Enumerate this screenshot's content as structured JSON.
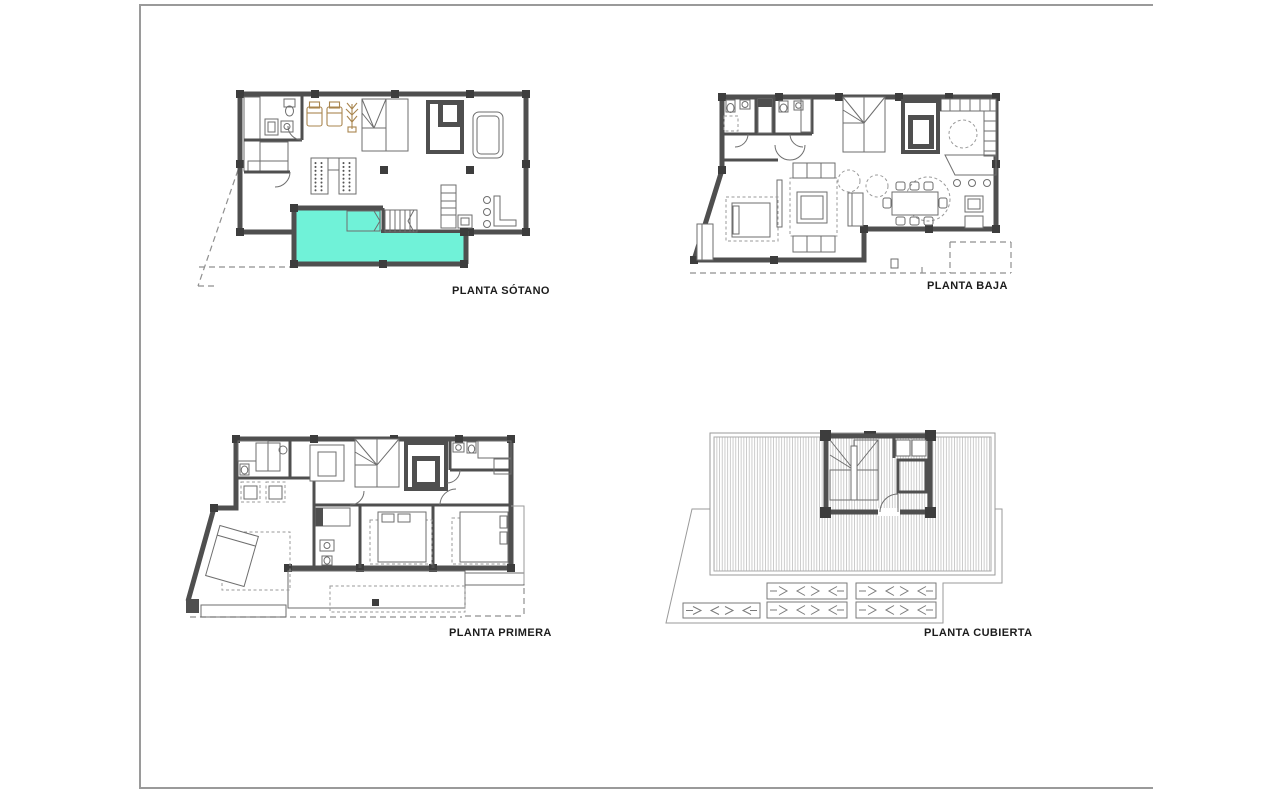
{
  "sheet": {
    "type": "architectural floor plan sheet",
    "frame_color": "#9a9a9a",
    "background": "#ffffff"
  },
  "drawing": {
    "wall_color": "#4f4f4f",
    "wall_dark": "#3d3d3d",
    "line_color": "#6e6e6e",
    "hatch_color": "#b3b3b3",
    "dash_color": "#8f8f8f",
    "pool_color": "#70f2d8",
    "furniture_tan": "#a8854e",
    "label_color": "#1c1c1c",
    "frame_color": "#9a9a9a"
  },
  "plans": [
    {
      "id": "sotano",
      "label": "PLANTA SÓTANO",
      "features": [
        "pool",
        "gym",
        "stairs",
        "garage-ramp",
        "bar-counter"
      ]
    },
    {
      "id": "baja",
      "label": "PLANTA BAJA",
      "features": [
        "living-room",
        "dining-table",
        "kitchen",
        "bathrooms",
        "terrace"
      ]
    },
    {
      "id": "primera",
      "label": "PLANTA PRIMERA",
      "features": [
        "bedrooms",
        "bathrooms",
        "wardrobes",
        "deck-terrace"
      ]
    },
    {
      "id": "cubierta",
      "label": "PLANTA CUBIERTA",
      "features": [
        "roof-deck",
        "stair-bulkhead",
        "pergolas"
      ]
    }
  ]
}
